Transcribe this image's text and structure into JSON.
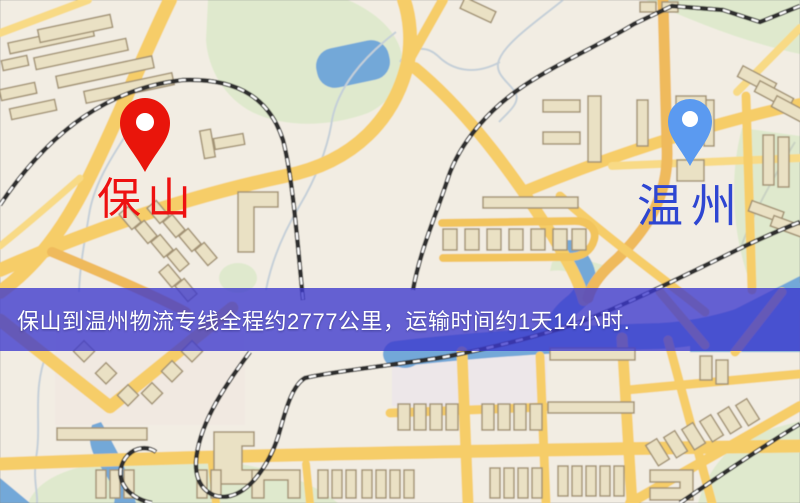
{
  "map": {
    "origin": {
      "label": "保山",
      "pin_icon": "red-location-pin",
      "pin_color": "#e9150b",
      "label_color": "#ee1111"
    },
    "destination": {
      "label": "温州",
      "pin_icon": "blue-location-pin",
      "pin_color": "#5b9af0",
      "label_color": "#2e46d2"
    },
    "banner": {
      "text": "保山到温州物流专线全程约2777公里，运输时间约1天14小时.",
      "bg_color": "rgba(60,56,205,0.78)",
      "text_color": "#ffffff"
    },
    "palette": {
      "base": "#f2ede3",
      "road": "#f6cd68",
      "road_minor": "#f8da85",
      "road_orange": "#efba5c",
      "building_fill": "#eae1c4",
      "building_stroke": "#a39374",
      "park": "#dfe9cd",
      "water": "#73a8d8",
      "railway": "#2e2e2e"
    }
  }
}
